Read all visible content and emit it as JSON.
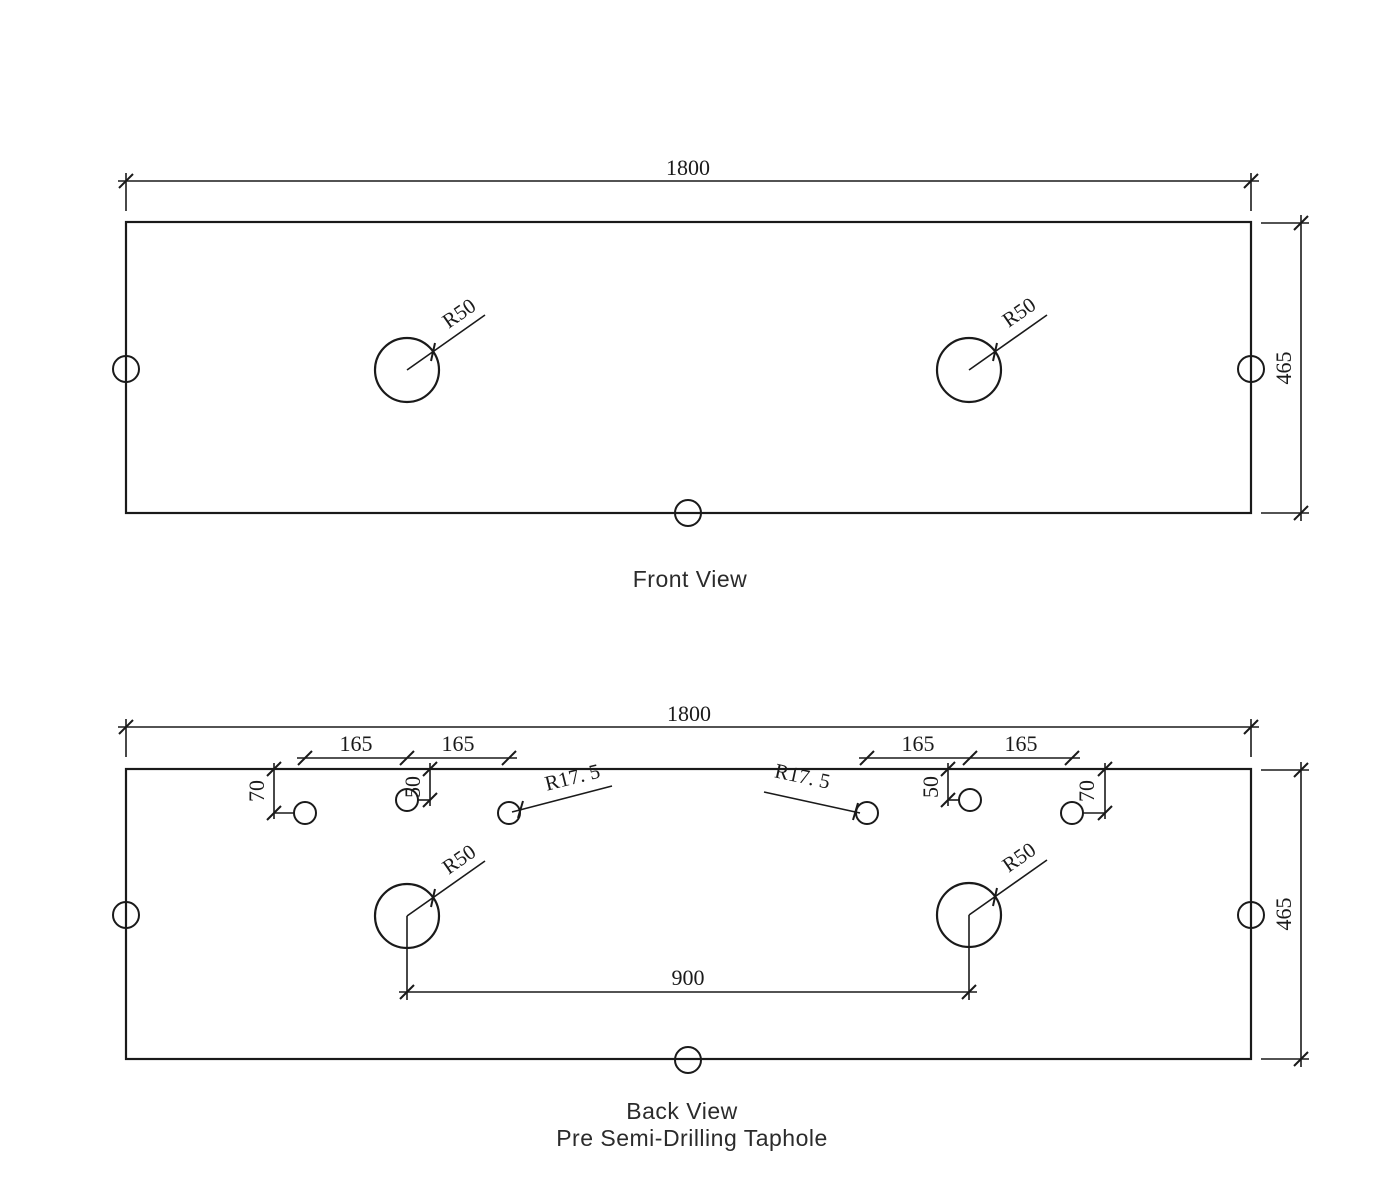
{
  "colors": {
    "line": "#1a1a1a",
    "background": "#ffffff",
    "title_text": "#2b2b2b"
  },
  "front_view": {
    "title": "Front View",
    "width_dim": "1800",
    "height_dim": "465",
    "left_hole_radius": "R50",
    "right_hole_radius": "R50"
  },
  "back_view": {
    "title": "Back View",
    "subtitle": "Pre Semi-Drilling Taphole",
    "width_dim": "1800",
    "height_dim": "465",
    "center_spacing_dim": "900",
    "left_hole_radius": "R50",
    "right_hole_radius": "R50",
    "left_taphole_group": {
      "spacing_a": "165",
      "spacing_b": "165",
      "edge_offset": "70",
      "center_offset": "50",
      "taphole_radius": "R17. 5"
    },
    "right_taphole_group": {
      "spacing_a": "165",
      "spacing_b": "165",
      "edge_offset": "70",
      "center_offset": "50",
      "taphole_radius": "R17. 5"
    }
  },
  "panel_specs": {
    "panel_width": 1800,
    "panel_height": 465,
    "main_hole_radius": 50,
    "main_hole_center_spacing": 900,
    "taphole_radius": 17.5,
    "taphole_spacing": 165,
    "taphole_edge_depth": 70,
    "taphole_center_depth": 50
  }
}
